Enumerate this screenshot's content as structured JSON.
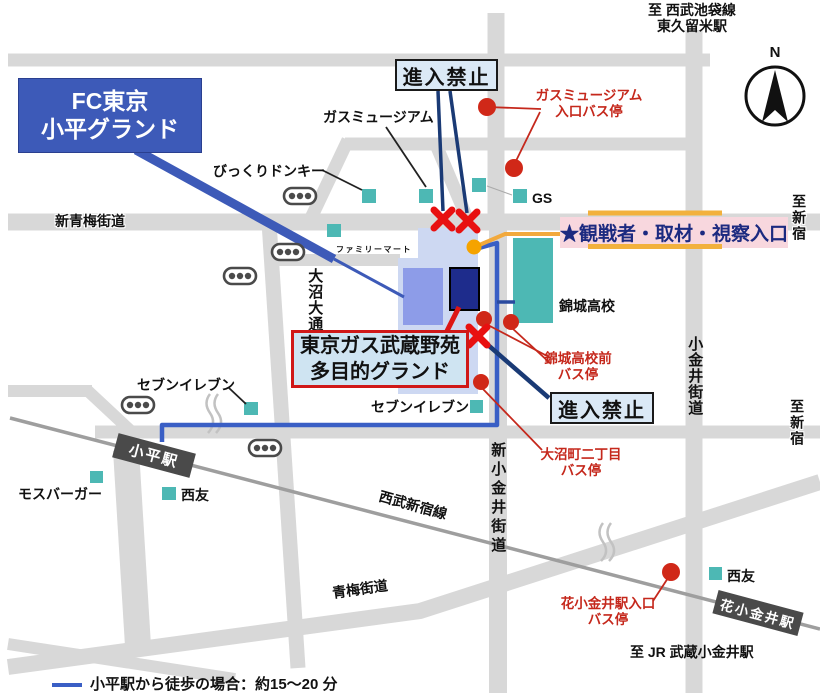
{
  "map": {
    "title_box": {
      "line1": "FC東京",
      "line2": "小平グランド"
    },
    "entrance_banner": "★観戦者・取材・視察入口",
    "ground_box": {
      "line1": "東京ガス武蔵野苑",
      "line2": "多目的グランド"
    },
    "no_entry_boxes": [
      "進入禁止",
      "進入禁止"
    ],
    "compass_north": "N",
    "legend": {
      "walk_note": "小平駅から徒歩の場合：約15～20 分"
    },
    "roads": {
      "shin_oume_kaido": "新青梅街道",
      "oume_kaido": "青梅街道",
      "koganei_kaido": "小金井街道",
      "shin_koganei_kaido": "新小金井街道",
      "oonuma_odori": "大沼大通り",
      "seibu_shinjuku_line": "西武新宿線"
    },
    "directions": {
      "seibu_ikebukuro": {
        "line1": "至 西武池袋線",
        "line2": "東久留米駅"
      },
      "shinjuku_upper": "至新宿",
      "shinjuku_lower": "至新宿",
      "jr_musashi_koganei": "至 JR 武蔵小金井駅"
    },
    "stations": {
      "kodaira": "小平駅",
      "hana_koganei": "花小金井駅"
    },
    "bus_stops": {
      "gas_museum_entrance": {
        "line1": "ガスミュージアム",
        "line2": "入口バス停"
      },
      "kinjo_mae": {
        "line1": "錦城高校前",
        "line2": "バス停"
      },
      "oonuma_2chome": {
        "line1": "大沼町二丁目",
        "line2": "バス停"
      },
      "hana_koganei_entrance": {
        "line1": "花小金井駅入口",
        "line2": "バス停"
      }
    },
    "landmarks": {
      "bikkuri_donkey": "びっくりドンキー",
      "gas_museum": "ガスミュージアム",
      "gs": "GS",
      "family_mart": "ファミリーマート",
      "kinjo_high_school": "錦城高校",
      "seven_eleven_west": "セブンイレブン",
      "seven_eleven_east": "セブンイレブン",
      "mos_burger": "モスバーガー",
      "seiyu_west": "西友",
      "seiyu_east": "西友"
    },
    "colors": {
      "road_gray": "#d8d8d8",
      "railway_gray": "#9e9e9e",
      "landmark_teal": "#4db8b4",
      "fc_blue": "#3d5ab8",
      "ground_light_blue": "#cdd8f2",
      "ground_field_blue": "#8d9ce8",
      "ground_building_navy": "#1e2c8c",
      "walk_route_blue": "#3a5fc5",
      "car_route_navy": "#1a3a75",
      "spectator_route_yellow": "#f2b13d",
      "bus_stop_red": "#d02818",
      "no_entry_red": "#e81010",
      "banner_pink": "#f8d7de"
    }
  }
}
